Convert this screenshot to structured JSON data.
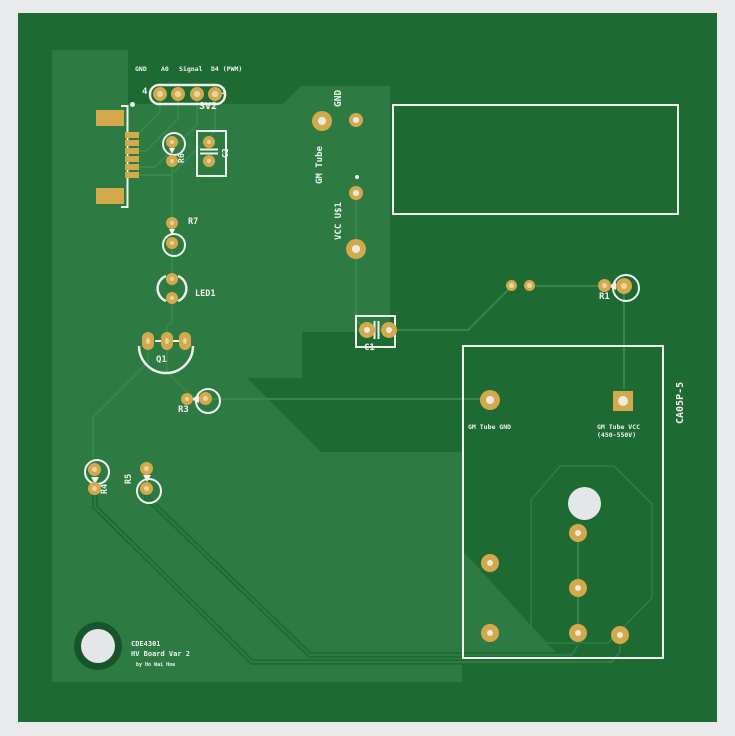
{
  "colors": {
    "page_background": "#e8eaec",
    "board_dark_green": "#1d6a33",
    "copper_pour_green": "#2d7b43",
    "trace_green": "#37874b",
    "pad_gold": "#d4a94c",
    "silkscreen_white": "#eef1ee"
  },
  "sv2": {
    "ref": "SV2",
    "pin_number_left": "4",
    "pin_number_right": "1",
    "pins": [
      "GND",
      "A0",
      "Signal",
      "D4 (PWM)"
    ]
  },
  "refs": {
    "r6": "R6",
    "c2": "C2",
    "r7": "R7",
    "led1": "LED1",
    "q1": "Q1",
    "r3": "R3",
    "r4": "R4",
    "r5": "R5",
    "c1": "C1",
    "r1": "R1"
  },
  "nets": {
    "gnd": "GND",
    "gm_tube": "GM Tube",
    "vcc_u1": "VCC U$1"
  },
  "hv_block": {
    "gm_tube_gnd": "GM Tube GND",
    "gm_tube_vcc": "GM Tube VCC",
    "vcc_range": "(450-550V)",
    "part_name": "CA05P-5"
  },
  "title_block": {
    "line1": "CDE4301",
    "line2": "HV Board Var 2",
    "line3": "by Ho Wai Hoe"
  }
}
